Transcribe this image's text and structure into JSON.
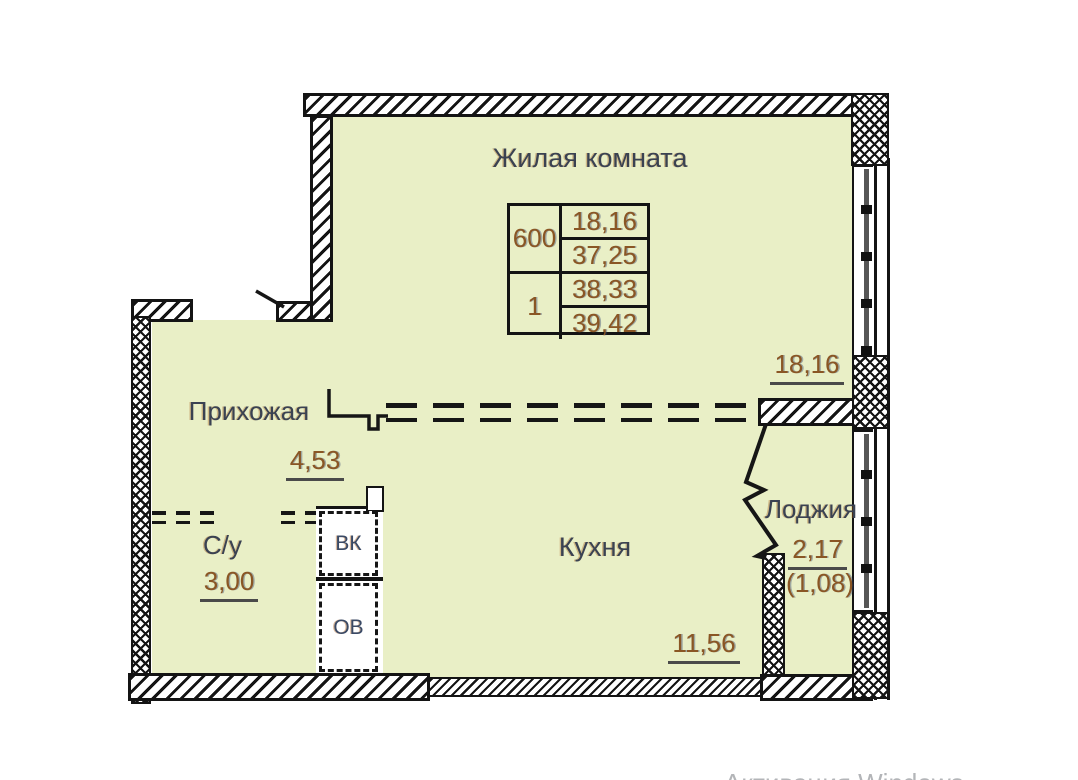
{
  "rooms": {
    "living": {
      "label": "Жилая комната",
      "dim": "18,16"
    },
    "hallway": {
      "label": "Прихожая",
      "area": "4,53"
    },
    "bathroom": {
      "label": "С/у",
      "area": "3,00"
    },
    "kitchen": {
      "label": "Кухня",
      "area": "11,56"
    },
    "loggia": {
      "label": "Лоджия",
      "area": "2,17",
      "area_alt": "(1,08)"
    }
  },
  "shafts": {
    "vk": "ВК",
    "ov": "ОВ"
  },
  "info_table": {
    "unit": "600",
    "rooms_count": "1",
    "values": [
      "18,16",
      "37,25",
      "38,33",
      "39,42"
    ]
  },
  "watermark": "Активация Windows",
  "colors": {
    "room_fill": "#e9efc6",
    "label_text": "#3a4252",
    "number_text": "#8a5624",
    "wall": "#141414"
  }
}
